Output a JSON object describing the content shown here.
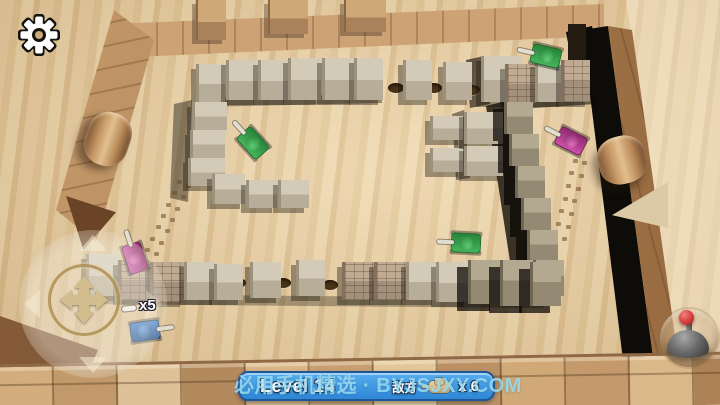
{
  "hud": {
    "level_label": "Level 14",
    "enemy_label": "敌方",
    "enemy_count_label": "x 6",
    "player_lives_label": "x5"
  },
  "watermark": {
    "text": "必用手机精选 · BYJSJXY.COM"
  },
  "icons": {
    "settings": "gear-icon",
    "move_pad": "four-way-arrow-pad",
    "fire_stick": "joystick-with-red-ball",
    "enemy_counter": "tan-tank-icon",
    "player_lives": "white-shell-icon"
  },
  "colors": {
    "hud_bar_top": "#58aeee",
    "hud_bar_bottom": "#2e86d7",
    "hud_bar_border": "#1f5796",
    "watermark_cyan": "#9bdcf0",
    "table_wood": "#e3c89a",
    "block_gray": "#cdc5b2",
    "brick_tan": "#b7a28c",
    "wall_brown": "#b98c5e",
    "shadow_black": "#0e0c08",
    "tank_green": "#2f9e44",
    "tank_purple": "#b5368e",
    "tank_blue": "#2b6cb8",
    "joystick_ball_red": "#d63c3c"
  },
  "scene": {
    "walls": [
      {
        "name": "table-highlight-right",
        "cls": "light-patch",
        "pts": [
          [
            626,
            0
          ],
          [
            720,
            0
          ],
          [
            720,
            405
          ],
          [
            688,
            405
          ],
          [
            676,
            356
          ],
          [
            630,
            28
          ]
        ]
      },
      {
        "name": "arena-wall-top",
        "cls": "wood-h",
        "pts": [
          [
            112,
            24
          ],
          [
            604,
            4
          ],
          [
            604,
            36
          ],
          [
            112,
            58
          ]
        ]
      },
      {
        "name": "arena-wall-left",
        "cls": "wood-d",
        "pts": [
          [
            114,
            10
          ],
          [
            154,
            40
          ],
          [
            96,
            242
          ],
          [
            56,
            210
          ]
        ]
      },
      {
        "name": "arena-wall-right-shadow",
        "cls": "black-face",
        "pts": [
          [
            582,
            30
          ],
          [
            608,
            26
          ],
          [
            654,
            364
          ],
          [
            624,
            368
          ]
        ]
      },
      {
        "name": "arena-wall-right",
        "cls": "wood-v",
        "pts": [
          [
            608,
            26
          ],
          [
            632,
            30
          ],
          [
            678,
            358
          ],
          [
            654,
            364
          ]
        ]
      },
      {
        "name": "corner-dark-block",
        "cls": "black-face",
        "pts": [
          [
            566,
            32
          ],
          [
            592,
            26
          ],
          [
            602,
            80
          ],
          [
            576,
            86
          ]
        ]
      },
      {
        "name": "table-edge-dark",
        "cls": "dark-wedge",
        "pts": [
          [
            0,
            316
          ],
          [
            98,
            350
          ],
          [
            74,
            405
          ],
          [
            0,
            405
          ]
        ]
      }
    ],
    "shadows": [
      {
        "pts": [
          [
            196,
            98
          ],
          [
            382,
            94
          ],
          [
            382,
            103
          ],
          [
            196,
            107
          ]
        ],
        "a": 0.38
      },
      {
        "pts": [
          [
            174,
            104
          ],
          [
            192,
            100
          ],
          [
            188,
            202
          ],
          [
            170,
            198
          ]
        ],
        "a": 0.42
      },
      {
        "pts": [
          [
            486,
            106
          ],
          [
            510,
            100
          ],
          [
            550,
            294
          ],
          [
            516,
            300
          ]
        ],
        "a": 0.78
      },
      {
        "pts": [
          [
            500,
            98
          ],
          [
            592,
            92
          ],
          [
            596,
            104
          ],
          [
            504,
            110
          ]
        ],
        "a": 0.55
      },
      {
        "pts": [
          [
            80,
            294
          ],
          [
            545,
            298
          ],
          [
            543,
            308
          ],
          [
            78,
            304
          ]
        ],
        "a": 0.3
      },
      {
        "pts": [
          [
            452,
            114
          ],
          [
            464,
            110
          ],
          [
            470,
            178
          ],
          [
            456,
            180
          ]
        ],
        "a": 0.45
      },
      {
        "pts": [
          [
            466,
            60
          ],
          [
            484,
            56
          ],
          [
            490,
            104
          ],
          [
            470,
            108
          ]
        ],
        "a": 0.6
      }
    ],
    "holes": [
      [
        396,
        88
      ],
      [
        434,
        88
      ],
      [
        472,
        90
      ],
      [
        238,
        283
      ],
      [
        283,
        283
      ],
      [
        330,
        285
      ]
    ],
    "tracks": [
      {
        "x1": 152,
        "y1": 252,
        "x2": 184,
        "y2": 184,
        "n": 7
      },
      {
        "x1": 560,
        "y1": 238,
        "x2": 580,
        "y2": 162,
        "n": 7
      }
    ],
    "blocks": [
      [
        196,
        0,
        28,
        40,
        "w"
      ],
      [
        268,
        0,
        38,
        34,
        "w"
      ],
      [
        344,
        0,
        40,
        32,
        "w"
      ],
      [
        568,
        24,
        18,
        36,
        "r"
      ],
      [
        196,
        64,
        26,
        38,
        "p"
      ],
      [
        226,
        60,
        30,
        40,
        "p"
      ],
      [
        258,
        60,
        28,
        40,
        "p"
      ],
      [
        288,
        58,
        30,
        42,
        "p"
      ],
      [
        322,
        58,
        30,
        42,
        "p"
      ],
      [
        354,
        58,
        26,
        42,
        "p"
      ],
      [
        403,
        60,
        26,
        40,
        "p"
      ],
      [
        443,
        62,
        26,
        38,
        "p"
      ],
      [
        481,
        56,
        38,
        46,
        "p"
      ],
      [
        505,
        64,
        28,
        40,
        "b"
      ],
      [
        535,
        62,
        26,
        40,
        "p"
      ],
      [
        561,
        60,
        26,
        42,
        "b"
      ],
      [
        192,
        102,
        32,
        28,
        "p"
      ],
      [
        190,
        130,
        32,
        28,
        "p"
      ],
      [
        188,
        158,
        34,
        28,
        "p"
      ],
      [
        212,
        174,
        30,
        30,
        "p"
      ],
      [
        246,
        180,
        28,
        28,
        "p"
      ],
      [
        278,
        180,
        28,
        28,
        "p"
      ],
      [
        430,
        116,
        30,
        24,
        "p"
      ],
      [
        430,
        148,
        30,
        24,
        "p"
      ],
      [
        464,
        112,
        36,
        32,
        "p"
      ],
      [
        464,
        146,
        36,
        30,
        "p"
      ],
      [
        504,
        102,
        26,
        32,
        "d"
      ],
      [
        509,
        134,
        27,
        32,
        "d"
      ],
      [
        515,
        166,
        27,
        32,
        "d"
      ],
      [
        521,
        198,
        27,
        32,
        "d"
      ],
      [
        527,
        230,
        28,
        32,
        "d"
      ],
      [
        533,
        260,
        28,
        36,
        "d"
      ],
      [
        86,
        254,
        30,
        42,
        "p"
      ],
      [
        118,
        260,
        30,
        40,
        "b"
      ],
      [
        150,
        262,
        32,
        40,
        "b"
      ],
      [
        184,
        262,
        30,
        38,
        "p"
      ],
      [
        214,
        264,
        26,
        36,
        "p"
      ],
      [
        250,
        262,
        28,
        36,
        "p"
      ],
      [
        296,
        260,
        26,
        36,
        "p"
      ],
      [
        342,
        262,
        30,
        38,
        "b"
      ],
      [
        374,
        262,
        30,
        38,
        "b"
      ],
      [
        406,
        262,
        28,
        38,
        "p"
      ],
      [
        436,
        262,
        30,
        40,
        "p"
      ],
      [
        468,
        260,
        30,
        44,
        "d"
      ],
      [
        500,
        260,
        30,
        46,
        "d"
      ],
      [
        530,
        262,
        28,
        44,
        "d"
      ]
    ],
    "cylinders": [
      {
        "x": 86,
        "y": 112,
        "w": 44,
        "h": 54,
        "r": 18
      },
      {
        "x": 598,
        "y": 136,
        "w": 48,
        "h": 48,
        "r": -15
      }
    ],
    "ramps": [
      {
        "x": 612,
        "y": 182,
        "w": 56,
        "h": 46,
        "clip": "0% 72%,100% 0%,100% 100%",
        "color": "#dcc9a6"
      },
      {
        "x": 66,
        "y": 196,
        "w": 50,
        "h": 54,
        "clip": "0% 0%,100% 30%,35% 100%",
        "color": "#6b4427"
      }
    ],
    "tanks": [
      {
        "x": 546,
        "y": 56,
        "color": "green",
        "angle": 193
      },
      {
        "x": 253,
        "y": 143,
        "color": "green",
        "angle": 228
      },
      {
        "x": 466,
        "y": 243,
        "color": "green",
        "angle": 183
      },
      {
        "x": 571,
        "y": 141,
        "color": "purple",
        "angle": 207
      },
      {
        "x": 135,
        "y": 258,
        "color": "purple",
        "angle": 252
      },
      {
        "x": 145,
        "y": 331,
        "color": "blue",
        "angle": 352
      }
    ],
    "bottom_planks": [
      "#d3ad7d",
      "#c1996a",
      "#dec197",
      "#b3895e",
      "#d8b687",
      "#c79f72",
      "#e2c79b",
      "#bb9164",
      "#d0a977",
      "#c49a6c",
      "#dbb88a",
      "#ad8257"
    ]
  }
}
